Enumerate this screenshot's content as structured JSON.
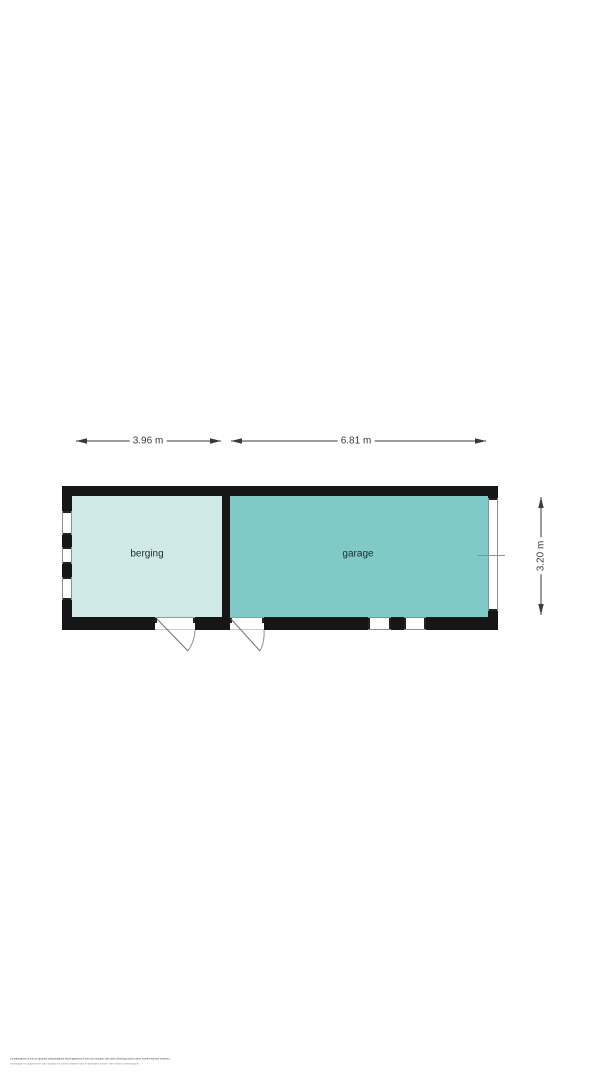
{
  "floorplan": {
    "rooms": [
      {
        "id": "berging",
        "label": "berging",
        "fill": "#cfe9e7"
      },
      {
        "id": "garage",
        "label": "garage",
        "fill": "#7fc9c6"
      }
    ],
    "dimensions": {
      "top_left": "3.96 m",
      "top_right": "6.81 m",
      "right_side": "3.20 m"
    },
    "features": {
      "doors": [
        "door-berging-bottom",
        "door-garage-bottom"
      ],
      "windows": [
        "window-left-1",
        "window-left-2",
        "window-left-3",
        "window-right",
        "window-bottom-1",
        "window-bottom-2"
      ]
    },
    "colors": {
      "wall": "#161616",
      "berging_fill": "#cfe9e7",
      "garage_fill": "#7fc9c6",
      "dimension_line": "#3a3a3a",
      "window_line": "#8f8f8f",
      "background": "#ffffff"
    }
  },
  "fine_print": {
    "line1": "De plattegrond is met de grootste zorgvuldigheid samengesteld en dient ter indicatie; aan deze tekening kunnen geen rechten worden ontleend.",
    "line2": "Afmetingen en oppervlakten zijn indicatief en kunnen afwijken van de werkelijke situatie. Alle rechten voorbehouden."
  }
}
